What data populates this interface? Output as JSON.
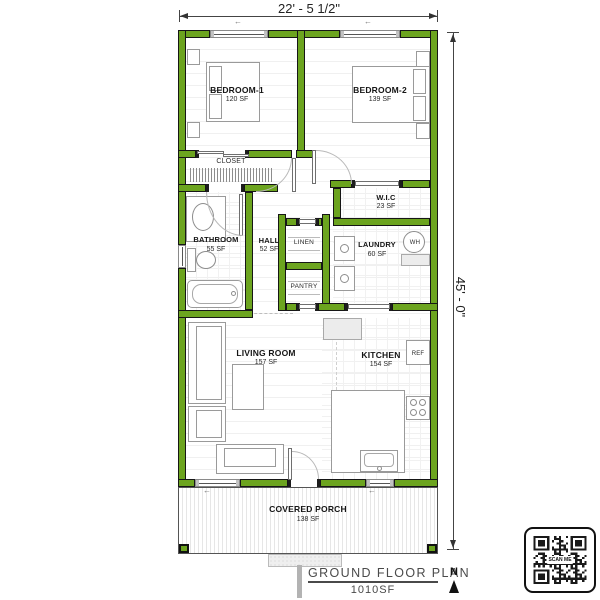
{
  "plan": {
    "width_dim": "22' - 5 1/2\"",
    "height_dim": "45' - 0\"",
    "title": "GROUND FLOOR PLAN",
    "total_area": "1010SF",
    "north_label": "N",
    "qr_label": "SCAN ME",
    "colors": {
      "wall_green": "#6ca41f",
      "outline_black": "#161616"
    },
    "rooms": {
      "bedroom1": {
        "name": "BEDROOM-1",
        "area": "120 SF"
      },
      "bedroom2": {
        "name": "BEDROOM-2",
        "area": "139 SF"
      },
      "closet": {
        "name": "CLOSET"
      },
      "wic": {
        "name": "W.I.C",
        "area": "23 SF"
      },
      "bathroom": {
        "name": "BATHROOM",
        "area": "55 SF"
      },
      "hall": {
        "name": "HALL",
        "area": "52 SF"
      },
      "linen": {
        "name": "LINEN"
      },
      "laundry": {
        "name": "LAUNDRY",
        "area": "60 SF"
      },
      "pantry": {
        "name": "PANTRY"
      },
      "living": {
        "name": "LIVING ROOM",
        "area": "157 SF"
      },
      "kitchen": {
        "name": "KITCHEN",
        "area": "154 SF"
      },
      "porch": {
        "name": "COVERED PORCH",
        "area": "138 SF"
      }
    },
    "fixtures": {
      "refrigerator": "REF",
      "water_heater": "WH"
    }
  }
}
